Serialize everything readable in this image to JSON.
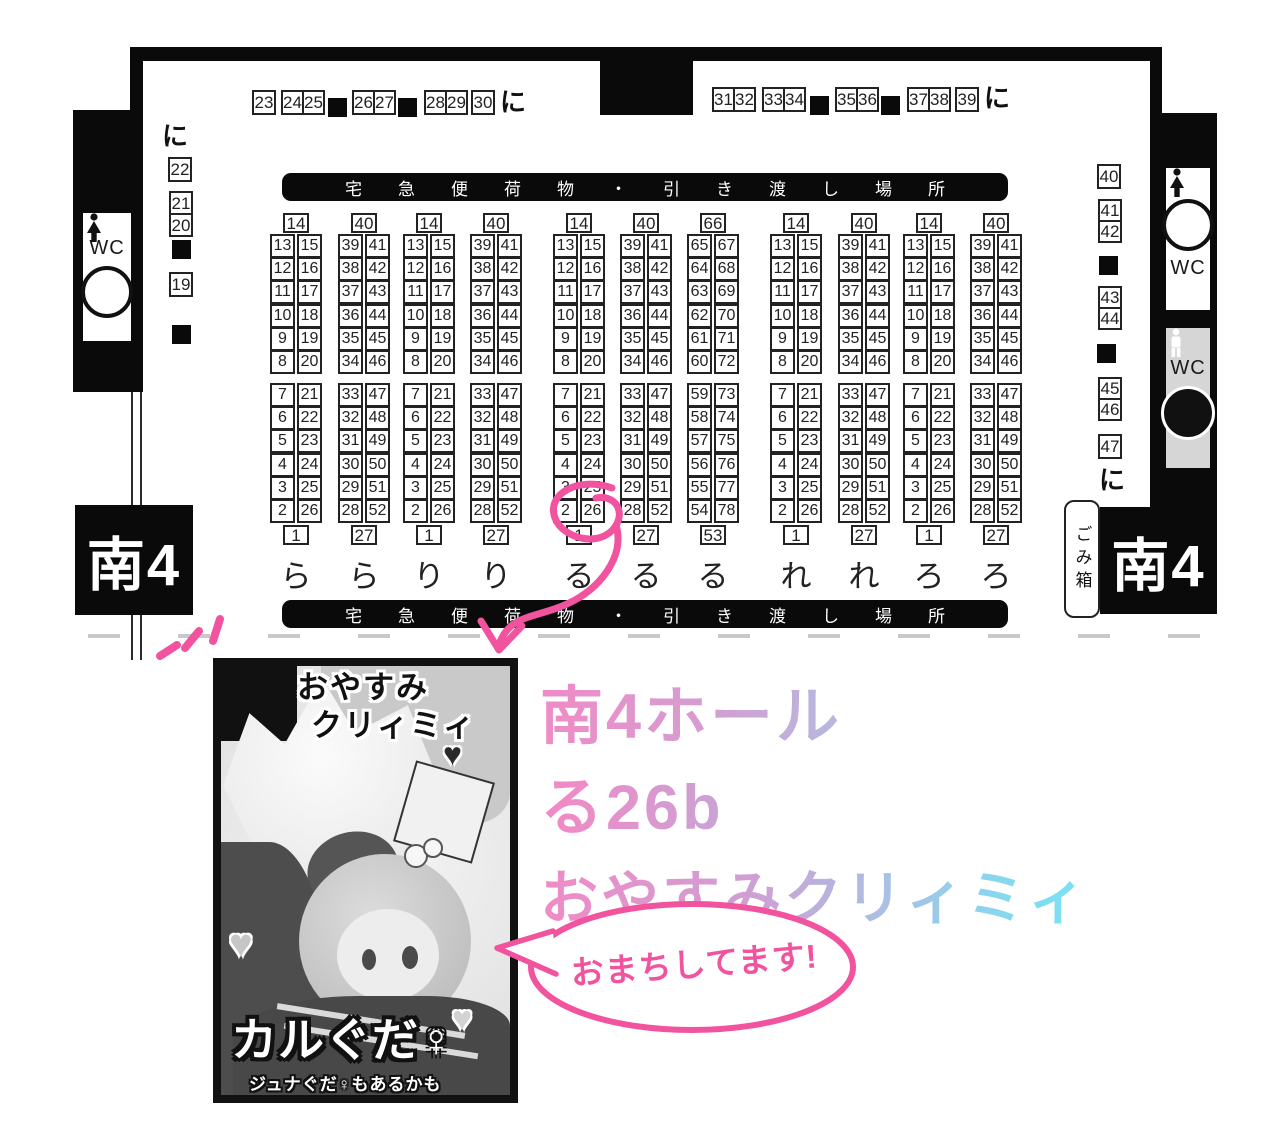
{
  "map": {
    "hall_name": "南4",
    "wc_label": "WC",
    "trash_label": "ごみ箱",
    "entrance_label": "に",
    "banner_text": "宅急便荷物・引き渡し場所",
    "top_seats_left": [
      "23",
      "24",
      "25",
      "26",
      "27",
      "28",
      "29",
      "30"
    ],
    "top_seats_right": [
      "31",
      "32",
      "33",
      "34",
      "35",
      "36",
      "37",
      "38",
      "39"
    ],
    "left_wall_seats": [
      "22",
      "21",
      "20",
      "19"
    ],
    "right_wall_seats": [
      "40",
      "41",
      "42",
      "43",
      "44",
      "45",
      "46",
      "47"
    ],
    "blocks": [
      {
        "letter": "ら",
        "header": "14",
        "footer": "1",
        "top_rows": [
          [
            "13",
            "15"
          ],
          [
            "12",
            "16"
          ],
          [
            "11",
            "17"
          ],
          [
            "10",
            "18"
          ],
          [
            "9",
            "19"
          ],
          [
            "8",
            "20"
          ]
        ],
        "bottom_rows": [
          [
            "7",
            "21"
          ],
          [
            "6",
            "22"
          ],
          [
            "5",
            "23"
          ],
          [
            "4",
            "24"
          ],
          [
            "3",
            "25"
          ],
          [
            "2",
            "26"
          ]
        ]
      },
      {
        "letter": "ら",
        "header": "40",
        "footer": "27",
        "top_rows": [
          [
            "39",
            "41"
          ],
          [
            "38",
            "42"
          ],
          [
            "37",
            "43"
          ],
          [
            "36",
            "44"
          ],
          [
            "35",
            "45"
          ],
          [
            "34",
            "46"
          ]
        ],
        "bottom_rows": [
          [
            "33",
            "47"
          ],
          [
            "32",
            "48"
          ],
          [
            "31",
            "49"
          ],
          [
            "30",
            "50"
          ],
          [
            "29",
            "51"
          ],
          [
            "28",
            "52"
          ]
        ]
      },
      {
        "letter": "り",
        "header": "14",
        "footer": "1",
        "top_rows": [
          [
            "13",
            "15"
          ],
          [
            "12",
            "16"
          ],
          [
            "11",
            "17"
          ],
          [
            "10",
            "18"
          ],
          [
            "9",
            "19"
          ],
          [
            "8",
            "20"
          ]
        ],
        "bottom_rows": [
          [
            "7",
            "21"
          ],
          [
            "6",
            "22"
          ],
          [
            "5",
            "23"
          ],
          [
            "4",
            "24"
          ],
          [
            "3",
            "25"
          ],
          [
            "2",
            "26"
          ]
        ]
      },
      {
        "letter": "り",
        "header": "40",
        "footer": "27",
        "top_rows": [
          [
            "39",
            "41"
          ],
          [
            "38",
            "42"
          ],
          [
            "37",
            "43"
          ],
          [
            "36",
            "44"
          ],
          [
            "35",
            "45"
          ],
          [
            "34",
            "46"
          ]
        ],
        "bottom_rows": [
          [
            "33",
            "47"
          ],
          [
            "32",
            "48"
          ],
          [
            "31",
            "49"
          ],
          [
            "30",
            "50"
          ],
          [
            "29",
            "51"
          ],
          [
            "28",
            "52"
          ]
        ]
      },
      {
        "letter": "る",
        "header": "14",
        "footer": "1",
        "top_rows": [
          [
            "13",
            "15"
          ],
          [
            "12",
            "16"
          ],
          [
            "11",
            "17"
          ],
          [
            "10",
            "18"
          ],
          [
            "9",
            "19"
          ],
          [
            "8",
            "20"
          ]
        ],
        "bottom_rows": [
          [
            "7",
            "21"
          ],
          [
            "6",
            "22"
          ],
          [
            "5",
            "23"
          ],
          [
            "4",
            "24"
          ],
          [
            "3",
            "25"
          ],
          [
            "2",
            "26"
          ]
        ]
      },
      {
        "letter": "る",
        "header": "40",
        "footer": "27",
        "top_rows": [
          [
            "39",
            "41"
          ],
          [
            "38",
            "42"
          ],
          [
            "37",
            "43"
          ],
          [
            "36",
            "44"
          ],
          [
            "35",
            "45"
          ],
          [
            "34",
            "46"
          ]
        ],
        "bottom_rows": [
          [
            "33",
            "47"
          ],
          [
            "32",
            "48"
          ],
          [
            "31",
            "49"
          ],
          [
            "30",
            "50"
          ],
          [
            "29",
            "51"
          ],
          [
            "28",
            "52"
          ]
        ]
      },
      {
        "letter": "る",
        "header": "66",
        "footer": "53",
        "top_rows": [
          [
            "65",
            "67"
          ],
          [
            "64",
            "68"
          ],
          [
            "63",
            "69"
          ],
          [
            "62",
            "70"
          ],
          [
            "61",
            "71"
          ],
          [
            "60",
            "72"
          ]
        ],
        "bottom_rows": [
          [
            "59",
            "73"
          ],
          [
            "58",
            "74"
          ],
          [
            "57",
            "75"
          ],
          [
            "56",
            "76"
          ],
          [
            "55",
            "77"
          ],
          [
            "54",
            "78"
          ]
        ]
      },
      {
        "letter": "れ",
        "header": "14",
        "footer": "1",
        "top_rows": [
          [
            "13",
            "15"
          ],
          [
            "12",
            "16"
          ],
          [
            "11",
            "17"
          ],
          [
            "10",
            "18"
          ],
          [
            "9",
            "19"
          ],
          [
            "8",
            "20"
          ]
        ],
        "bottom_rows": [
          [
            "7",
            "21"
          ],
          [
            "6",
            "22"
          ],
          [
            "5",
            "23"
          ],
          [
            "4",
            "24"
          ],
          [
            "3",
            "25"
          ],
          [
            "2",
            "26"
          ]
        ]
      },
      {
        "letter": "れ",
        "header": "40",
        "footer": "27",
        "top_rows": [
          [
            "39",
            "41"
          ],
          [
            "38",
            "42"
          ],
          [
            "37",
            "43"
          ],
          [
            "36",
            "44"
          ],
          [
            "35",
            "45"
          ],
          [
            "34",
            "46"
          ]
        ],
        "bottom_rows": [
          [
            "33",
            "47"
          ],
          [
            "32",
            "48"
          ],
          [
            "31",
            "49"
          ],
          [
            "30",
            "50"
          ],
          [
            "29",
            "51"
          ],
          [
            "28",
            "52"
          ]
        ]
      },
      {
        "letter": "ろ",
        "header": "14",
        "footer": "1",
        "top_rows": [
          [
            "13",
            "15"
          ],
          [
            "12",
            "16"
          ],
          [
            "11",
            "17"
          ],
          [
            "10",
            "18"
          ],
          [
            "9",
            "19"
          ],
          [
            "8",
            "20"
          ]
        ],
        "bottom_rows": [
          [
            "7",
            "21"
          ],
          [
            "6",
            "22"
          ],
          [
            "5",
            "23"
          ],
          [
            "4",
            "24"
          ],
          [
            "3",
            "25"
          ],
          [
            "2",
            "26"
          ]
        ]
      },
      {
        "letter": "ろ",
        "header": "40",
        "footer": "27",
        "top_rows": [
          [
            "39",
            "41"
          ],
          [
            "38",
            "42"
          ],
          [
            "37",
            "43"
          ],
          [
            "36",
            "44"
          ],
          [
            "35",
            "45"
          ],
          [
            "34",
            "46"
          ]
        ],
        "bottom_rows": [
          [
            "33",
            "47"
          ],
          [
            "32",
            "48"
          ],
          [
            "31",
            "49"
          ],
          [
            "30",
            "50"
          ],
          [
            "29",
            "51"
          ],
          [
            "28",
            "52"
          ]
        ]
      }
    ]
  },
  "announcement": {
    "hall_line": "南4ホール",
    "booth_line": "る26b",
    "circle_line": "おやすみクリィミィ",
    "bubble_text": "おまちしてます!"
  },
  "cover": {
    "title_line1": "おやすみ",
    "title_line2": "クリィミィ",
    "circle_name": "カルぐだ♀",
    "note": "ジュナぐだ♀もあるかも",
    "heart_glyph": "♥"
  },
  "colors": {
    "annotation_pink": "#f2539f",
    "heading_pink": "#f08bc6",
    "heading_lavender": "#b5badf",
    "heading_purple": "#c9a3d6",
    "heading_cyan": "#7ae2f3",
    "wall_black": "#0a0a0a",
    "male_wc_gray": "#d6d6d6"
  }
}
